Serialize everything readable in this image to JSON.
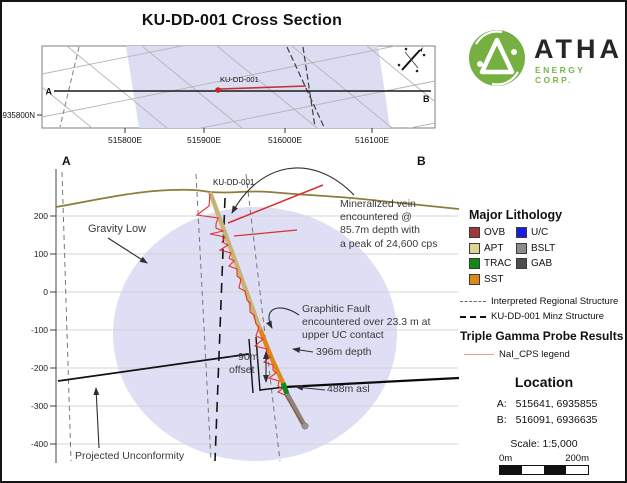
{
  "title": "KU-DD-001 Cross Section",
  "logo": {
    "brand": "ATHA",
    "subtitle": "ENERGY CORP."
  },
  "map": {
    "label_a": "A",
    "label_b": "B",
    "hole_label": "KU-DD-001",
    "y_tick": "6935800N",
    "x_ticks": [
      "515800E",
      "515900E",
      "516000E",
      "516100E"
    ]
  },
  "section": {
    "label_a": "A",
    "label_b": "B",
    "hole_label": "KU-DD-001",
    "y_ticks": [
      "200",
      "100",
      "0",
      "-100",
      "-200",
      "-300",
      "-400"
    ],
    "ann": {
      "gravity_low": "Gravity Low",
      "vein_l1": "Mineralized vein",
      "vein_l2": "encountered @",
      "vein_l3": "85.7m depth with",
      "vein_l4": "a peak of 24,600 cps",
      "fault_l1": "Graphitic Fault",
      "fault_l2": "encountered  over 23.3 m at",
      "fault_l3": "upper UC contact",
      "offset_l1": "~ 90m",
      "offset_l2": "offset",
      "depth": "396m depth",
      "asl": "488m asl",
      "unconformity": "Projected Unconformity"
    },
    "colors": {
      "gravity_low_fill": "#dedef4",
      "gamma_trace": "#e8302a",
      "vein_red": "#d93030",
      "topography": "#8b7d3a"
    }
  },
  "legend": {
    "lithology_title": "Major Lithology",
    "lithology": [
      {
        "label": "OVB",
        "color": "#9e3a32"
      },
      {
        "label": "U/C",
        "color": "#1a1ae0"
      },
      {
        "label": "APT",
        "color": "#dcd59a"
      },
      {
        "label": "BSLT",
        "color": "#8c8c8c"
      },
      {
        "label": "TRAC",
        "color": "#0f8a12"
      },
      {
        "label": "GAB",
        "color": "#4d4d4d"
      },
      {
        "label": "SST",
        "color": "#e08619"
      }
    ],
    "structures": [
      {
        "label": "Interpreted Regional Structure",
        "style": "gray-dash"
      },
      {
        "label": "KU-DD-001 Minz Structure",
        "style": "black-dash"
      }
    ],
    "gamma_title": "Triple Gamma  Probe Results",
    "gamma_legend": "NaI_CPS legend",
    "location_title": "Location",
    "location_a_label": "A:",
    "location_a_value": "515641, 6935855",
    "location_b_label": "B:",
    "location_b_value": "516091, 6936635",
    "scale_text": "Scale: 1:5,000",
    "scale_left": "0m",
    "scale_right": "200m"
  }
}
